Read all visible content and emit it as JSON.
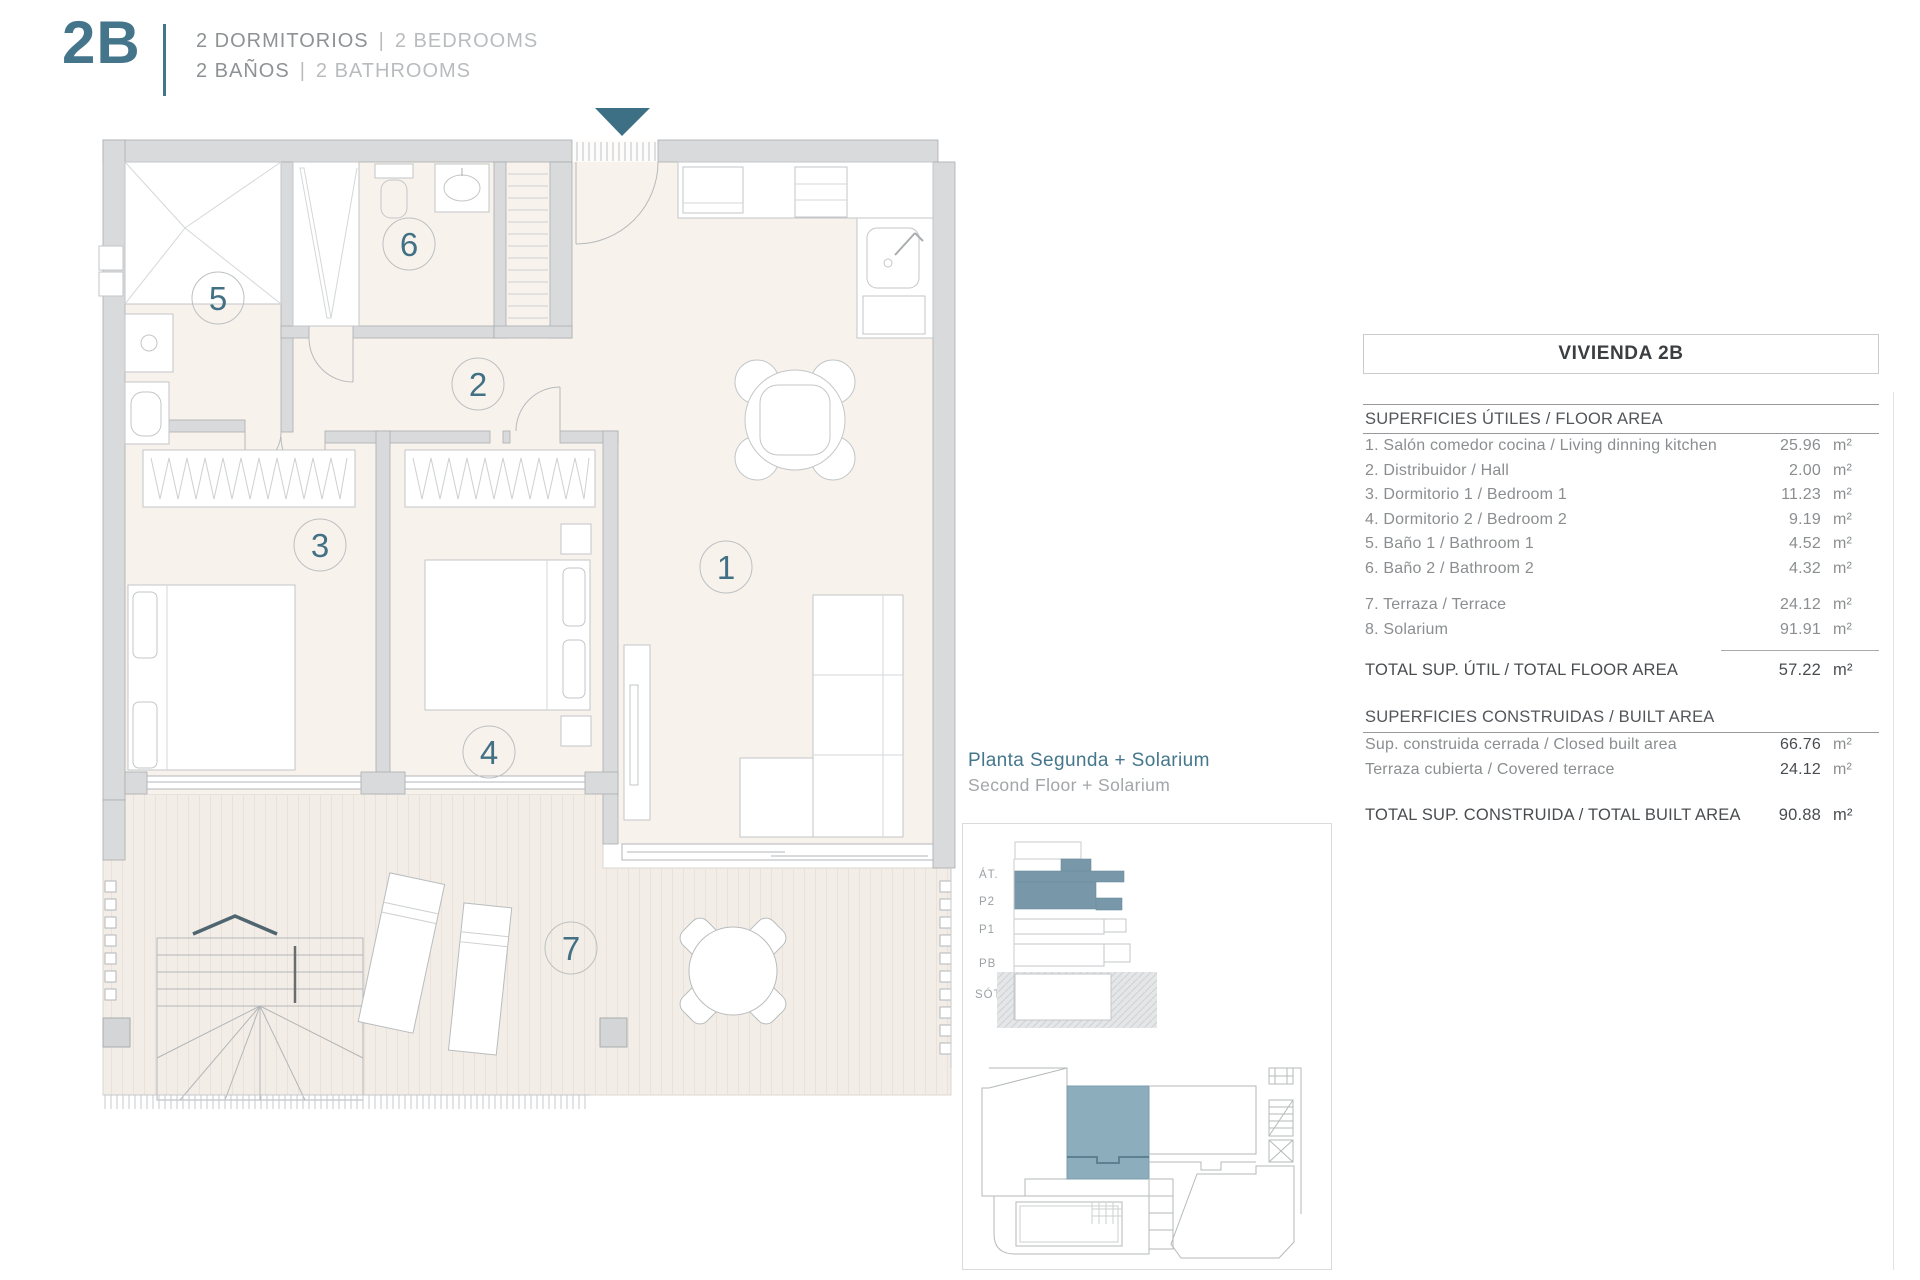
{
  "header": {
    "unit_code": "2B",
    "separator": "|",
    "line1_es": "2 DORMITORIOS",
    "line1_en": "2 BEDROOMS",
    "line2_es": "2 BAÑOS",
    "line2_en": "2 BATHROOMS"
  },
  "plan": {
    "room_numbers": [
      "1",
      "2",
      "3",
      "4",
      "5",
      "6",
      "7"
    ]
  },
  "keyplan": {
    "title_es": "Planta Segunda + Solarium",
    "title_en": "Second Floor + Solarium",
    "floor_labels": [
      "ÁT.",
      "P2",
      "P1",
      "PB",
      "SÓT."
    ]
  },
  "table": {
    "title": "VIVIENDA 2B",
    "section1": "SUPERFICIES ÚTILES / FLOOR AREA",
    "rows": [
      {
        "label": "1. Salón comedor cocina / Living dinning kitchen",
        "value": "25.96",
        "unit": "m²"
      },
      {
        "label": "2. Distribuidor / Hall",
        "value": "2.00",
        "unit": "m²"
      },
      {
        "label": "3. Dormitorio 1 / Bedroom 1",
        "value": "11.23",
        "unit": "m²"
      },
      {
        "label": "4. Dormitorio 2 / Bedroom 2",
        "value": "9.19",
        "unit": "m²"
      },
      {
        "label": "5. Baño 1 / Bathroom 1",
        "value": "4.52",
        "unit": "m²"
      },
      {
        "label": "6. Baño 2 / Bathroom 2",
        "value": "4.32",
        "unit": "m²"
      },
      {
        "label": "7. Terraza / Terrace",
        "value": "24.12",
        "unit": "m²"
      },
      {
        "label": "8. Solarium",
        "value": "91.91",
        "unit": "m²"
      }
    ],
    "total1": {
      "label": "TOTAL SUP. ÚTIL / TOTAL FLOOR AREA",
      "value": "57.22",
      "unit": "m²"
    },
    "section2": "SUPERFICIES CONSTRUIDAS / BUILT AREA",
    "rows2": [
      {
        "label": "Sup. construida cerrada / Closed built area",
        "value": "66.76",
        "unit": "m²"
      },
      {
        "label": "Terraza cubierta / Covered terrace",
        "value": "24.12",
        "unit": "m²"
      }
    ],
    "total2": {
      "label": "TOTAL SUP. CONSTRUIDA /  TOTAL BUILT AREA",
      "value": "90.88",
      "unit": "m²"
    }
  },
  "colors": {
    "accent": "#45758b",
    "accent_dark": "#3e7085",
    "unit_highlight": "#8badbc",
    "wall": "#d8dadb",
    "floor": "#f8f2ed",
    "deck": "#f3ede7"
  }
}
